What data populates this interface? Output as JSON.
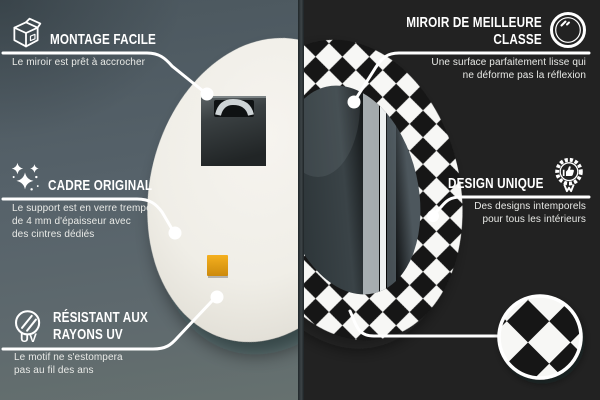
{
  "callouts": {
    "montage": {
      "title": "MONTAGE FACILE",
      "subtitle": "Le miroir est prêt à accrocher"
    },
    "cadre": {
      "title": "CADRE ORIGINAL",
      "subtitle_line1": "Le support est en verre trempé",
      "subtitle_line2": "de 4 mm d'épaisseur avec",
      "subtitle_line3": "des cintres dédiés"
    },
    "uv": {
      "title_line1": "RÉSISTANT AUX",
      "title_line2": "RAYONS UV",
      "icon_label": "UV",
      "subtitle_line1": "Le motif ne s'estompera",
      "subtitle_line2": "pas au fil des ans"
    },
    "miroir": {
      "title_line1": "MIROIR DE MEILLEURE",
      "title_line2": "CLASSE",
      "subtitle_line1": "Une surface parfaitement lisse qui",
      "subtitle_line2": "ne déforme pas la réflexion"
    },
    "design": {
      "title": "DESIGN UNIQUE",
      "subtitle_line1": "Des designs intemporels",
      "subtitle_line2": "pour tous les intérieurs"
    }
  },
  "icons": {
    "montage": "package-box-icon",
    "cadre": "sparkles-icon",
    "uv": "uv-protection-icon",
    "miroir": "round-mirror-icon",
    "design": "award-badge-icon",
    "swatch": "pattern-detail-magnifier"
  },
  "colors": {
    "wall_left": "#57636a",
    "wall_right": "#333d40",
    "divider": "#2c3336",
    "mirror_back": "#f2f0e9",
    "checker_black": "#141414",
    "checker_white": "#f7f7f5",
    "sticker_orange": "#eda315",
    "callout_white": "#ffffff"
  }
}
